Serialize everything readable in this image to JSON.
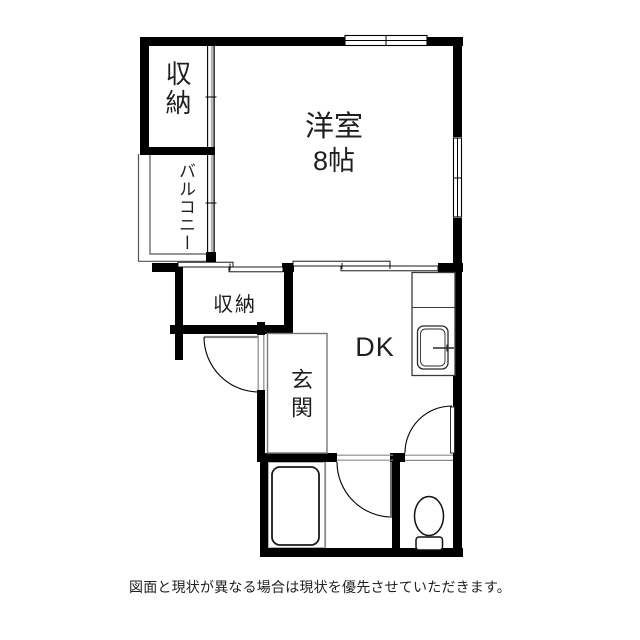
{
  "floor_plan": {
    "rooms": {
      "storage_top": {
        "label": "収納"
      },
      "balcony": {
        "label": "バルコニー"
      },
      "western_room": {
        "label": "洋室",
        "size": "8帖"
      },
      "storage_middle": {
        "label": "収納"
      },
      "dining_kitchen": {
        "label": "DK"
      },
      "entrance": {
        "label": "玄関"
      }
    },
    "fixtures": [
      "bathtub",
      "toilet",
      "kitchen-sink"
    ],
    "colors": {
      "wall": "#000000",
      "thin_line": "#777777",
      "background": "#ffffff"
    },
    "disclaimer": "図面と現状が異なる場合は現状を優先させていただきます。"
  }
}
